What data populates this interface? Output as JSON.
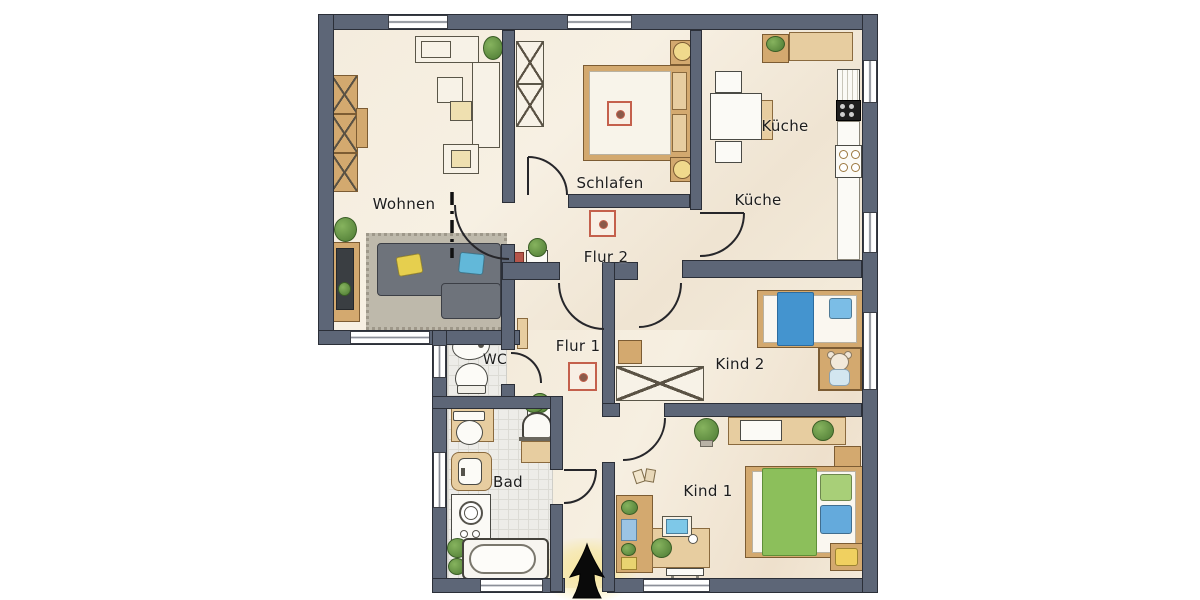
{
  "rooms": {
    "wohnen": {
      "label": "Wohnen"
    },
    "schlafen": {
      "label": "Schlafen"
    },
    "kueche_upper": {
      "label": "Küche"
    },
    "kueche_lower": {
      "label": "Küche"
    },
    "flur2": {
      "label": "Flur 2"
    },
    "flur1": {
      "label": "Flur 1"
    },
    "wc": {
      "label": "WC"
    },
    "bad": {
      "label": "Bad"
    },
    "kind2": {
      "label": "Kind 2"
    },
    "kind1": {
      "label": "Kind 1"
    }
  },
  "entrance": {
    "marker": "entrance-arrow",
    "glow_color": "#f7e596"
  },
  "colors": {
    "wall": "#5d6677",
    "wall_outline": "#2b2f38",
    "floor_cream": "#f4ecdd",
    "tile": "#edece8",
    "wood": "#d3a96f",
    "sofa_gray": "#6e737b",
    "pillow_yellow": "#e6cf4e",
    "pillow_blue": "#62b8d9",
    "blanket_blue": "#4494cf",
    "blanket_green": "#8cbf5b",
    "ornament_red": "#c4604c",
    "arrow_black": "#0a0a0a"
  },
  "furniture": {
    "wohnen": [
      "wardrobe-x",
      "sideboard",
      "plant",
      "shelf",
      "side-tables",
      "rug",
      "sofa",
      "tv-board"
    ],
    "schlafen": [
      "wardrobe-x",
      "double-bed",
      "nightstand",
      "nightstand",
      "ornament-rug"
    ],
    "kueche": [
      "upper-cabinet",
      "counter",
      "fridge",
      "stove",
      "hob",
      "dining-table",
      "chairs"
    ],
    "flur2": [
      "plant-stand",
      "ornament-rug"
    ],
    "flur1": [
      "ornament-rug",
      "plant-stand",
      "slim-cabinet"
    ],
    "wc": [
      "sink",
      "toilet"
    ],
    "bad": [
      "toilet",
      "sink",
      "washing-machine",
      "bathtub",
      "plants",
      "towel-dryer",
      "shelf"
    ],
    "kind2": [
      "single-bed-blue",
      "teddy-bear-box",
      "desk-x",
      "chair"
    ],
    "kind1": [
      "bench",
      "plants",
      "bed-green",
      "nightstand",
      "stool",
      "desk",
      "monitor",
      "bookshelf"
    ]
  }
}
